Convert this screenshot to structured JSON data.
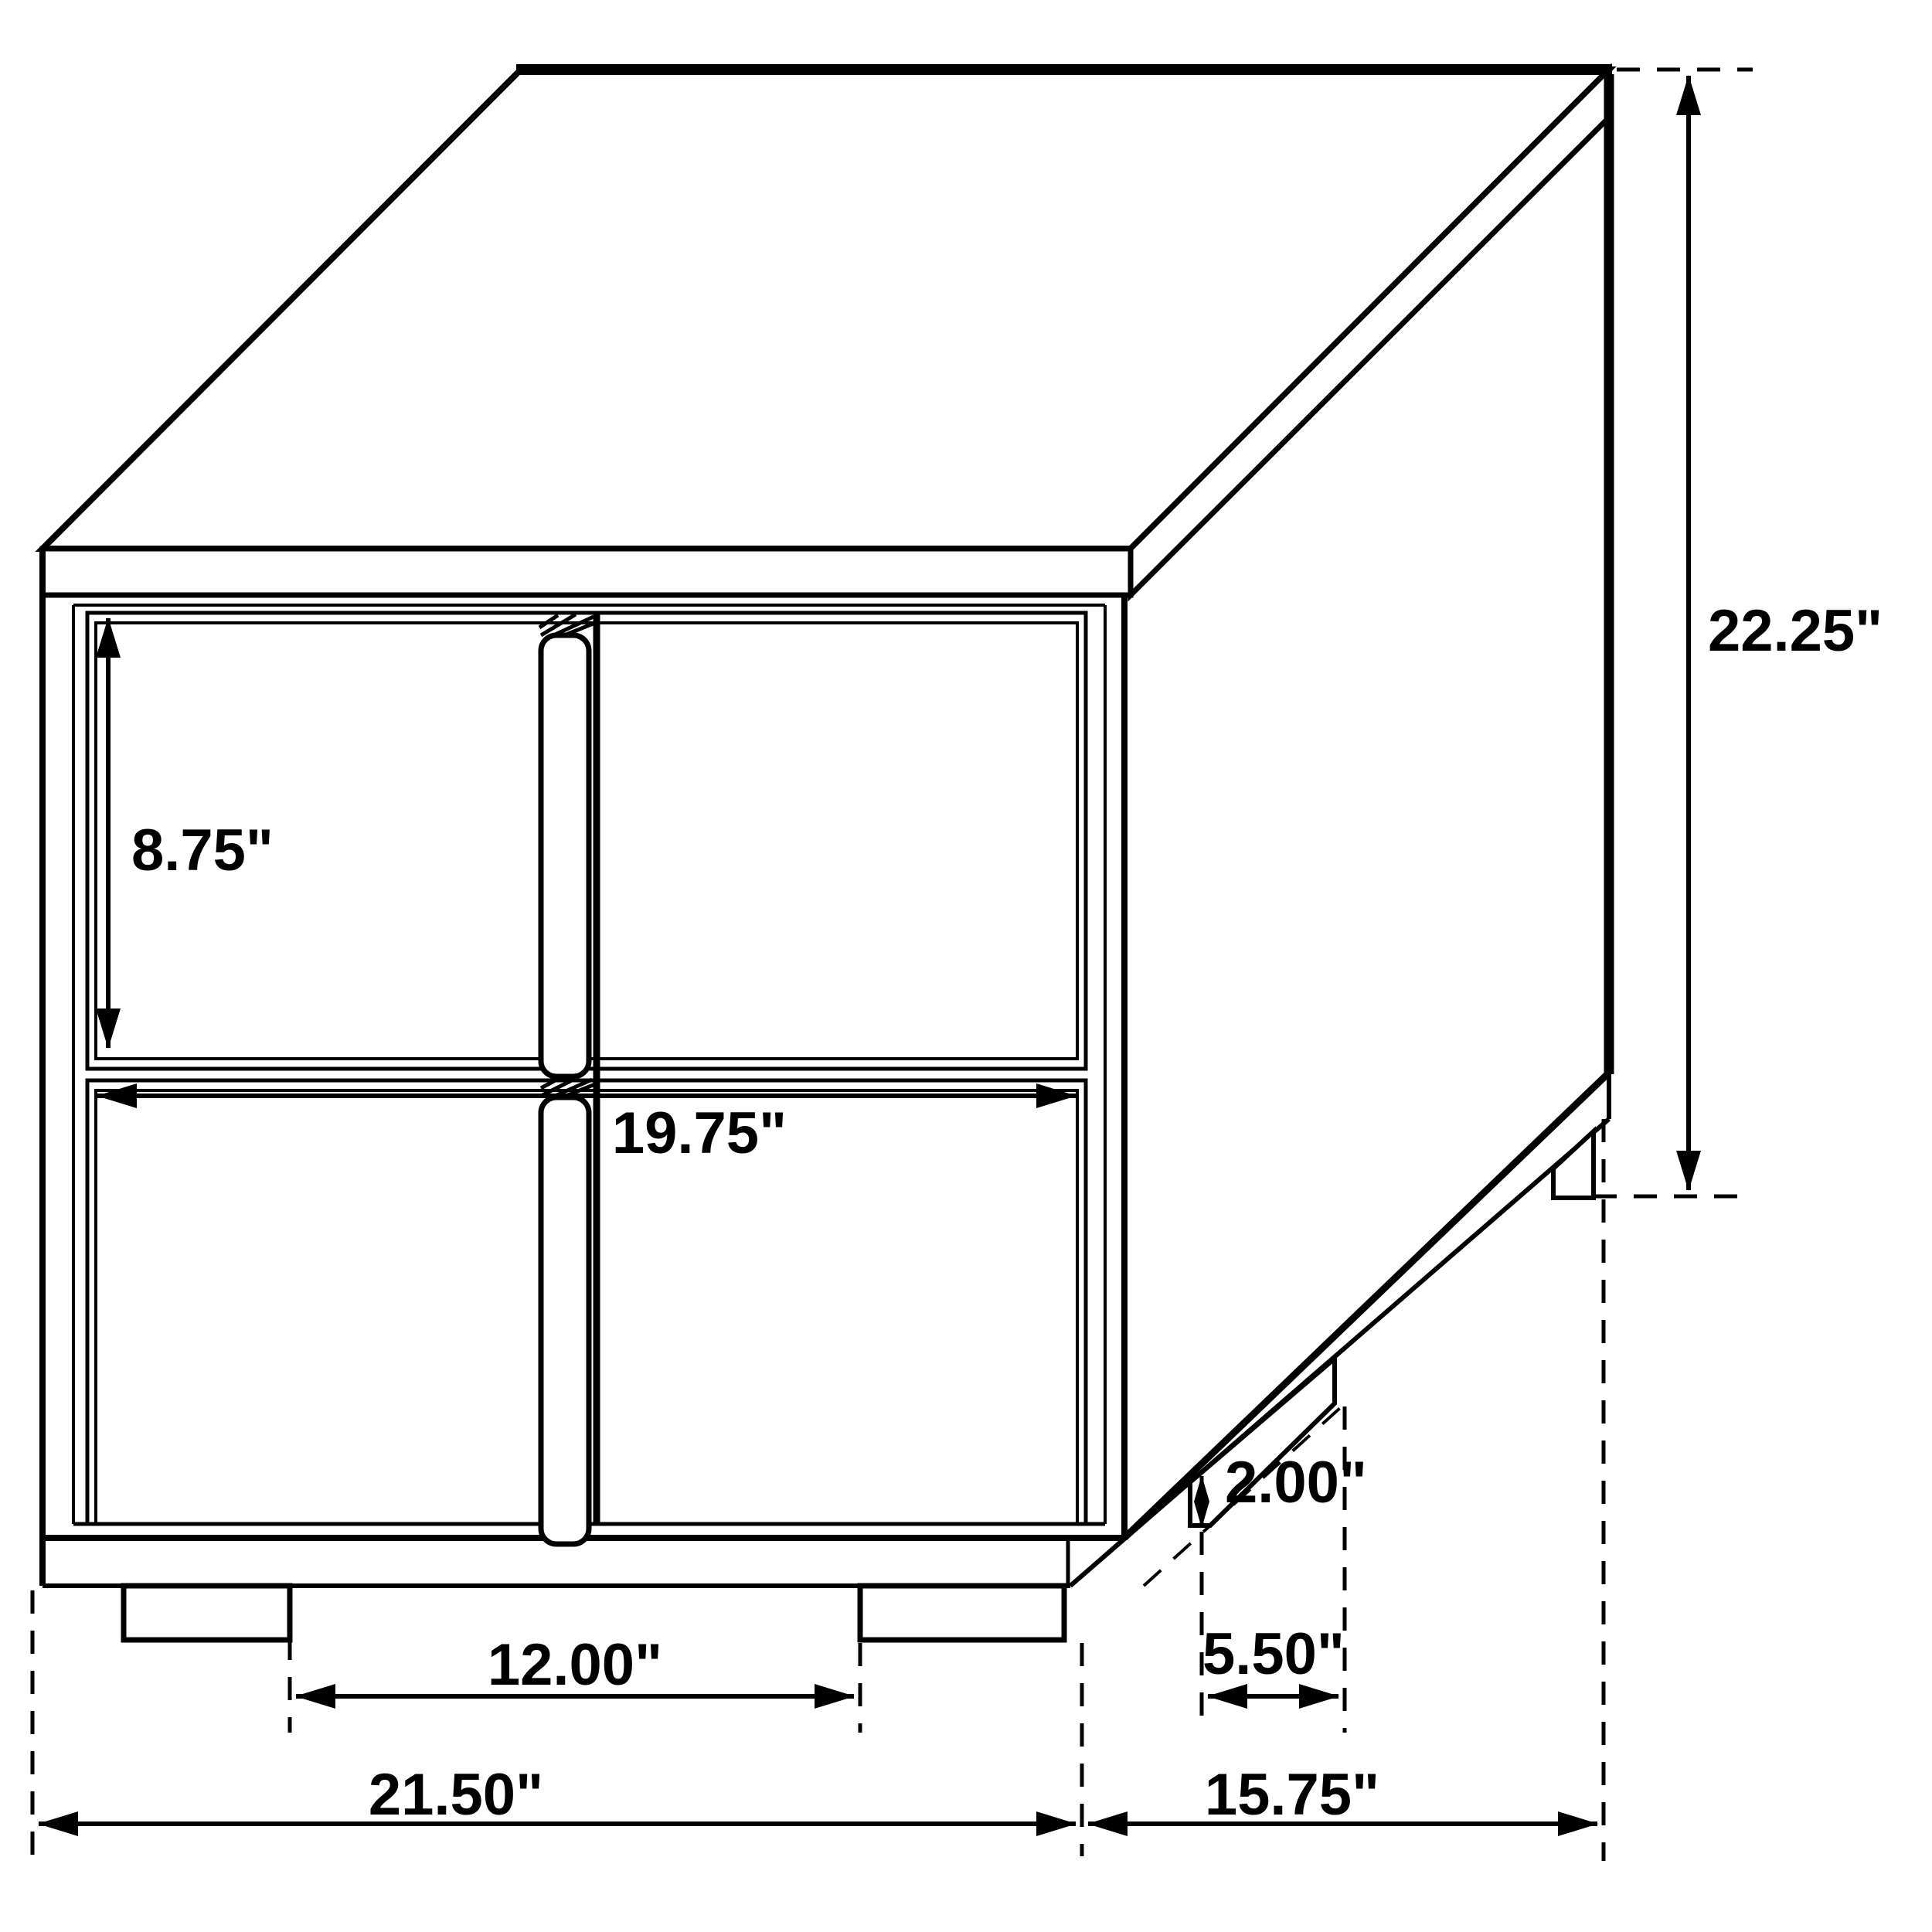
{
  "page": {
    "background": "#ffffff",
    "line_color": "#000000"
  },
  "diagram": {
    "kind": "furniture-dimension-line-drawing",
    "units": "inches",
    "labels": {
      "drawer_height": "8.75\"",
      "drawer_width": "19.75\"",
      "overall_height": "22.25\"",
      "foot_height": "2.00\"",
      "side_foot_spacing": "5.50\"",
      "front_foot_spacing": "12.00\"",
      "overall_width": "21.50\"",
      "overall_depth": "15.75\""
    }
  }
}
